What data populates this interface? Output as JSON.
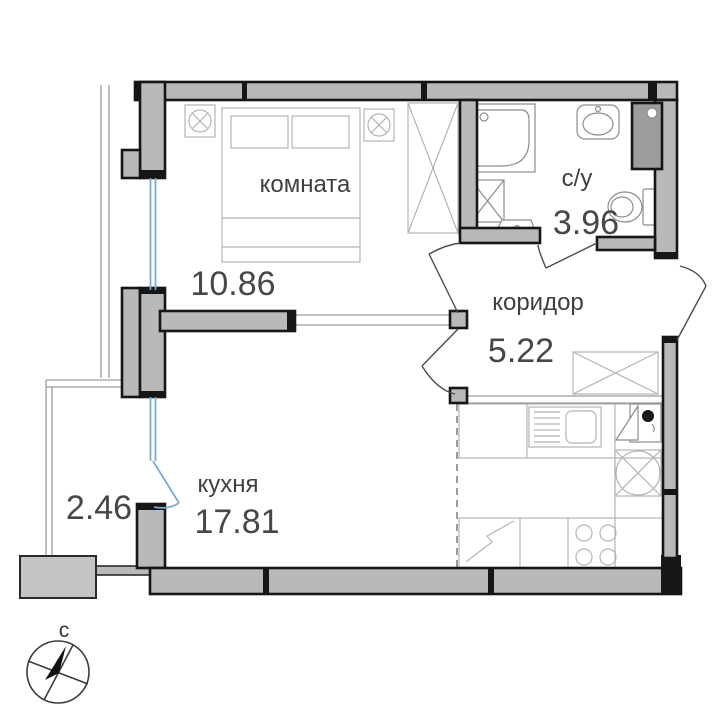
{
  "plan": {
    "rooms": {
      "komnata": {
        "label": "комната",
        "area": "10.86"
      },
      "bathroom": {
        "label": "с/у",
        "area": "3.96"
      },
      "corridor": {
        "label": "коридор",
        "area": "5.22"
      },
      "kitchen": {
        "label": "кухня",
        "area": "17.81"
      },
      "balcony": {
        "area": "2.46"
      }
    },
    "compass": {
      "north_label": "с"
    },
    "colors": {
      "background": "#ffffff",
      "wall_fill": "#b9b9b9",
      "wall_outline": "#161616",
      "duct_fill": "#9d9d9d",
      "window_blue": "#74aad2",
      "furniture_line": "#b4b4b4",
      "thin_line": "#9a9a9a",
      "text": "#3f3f3f"
    }
  }
}
